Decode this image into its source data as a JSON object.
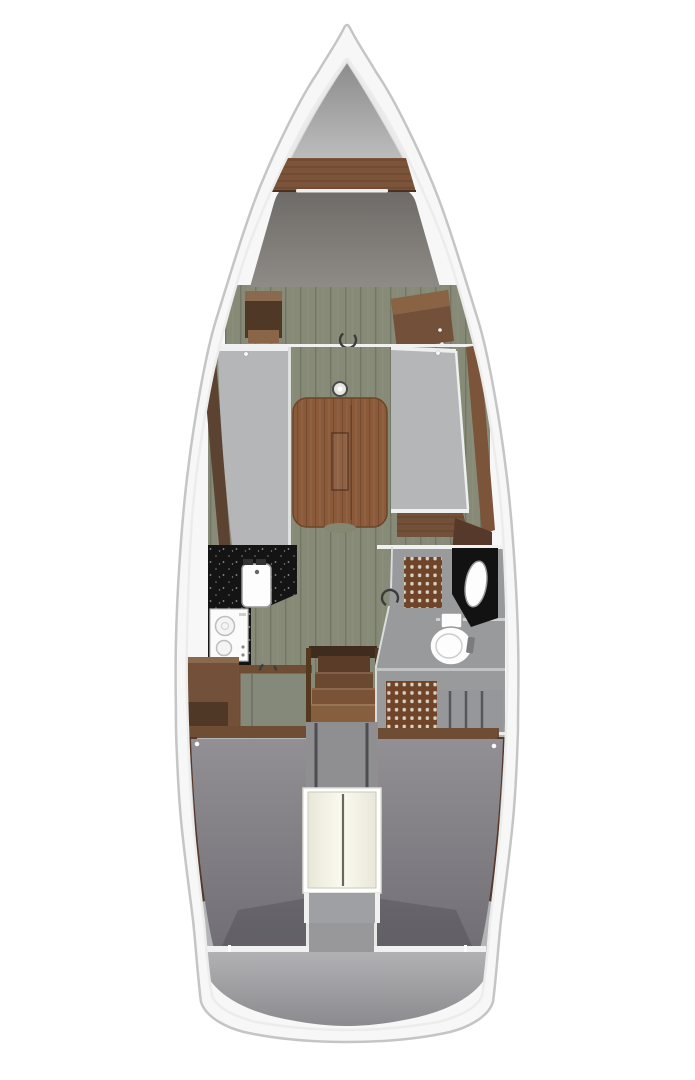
{
  "diagram": {
    "type": "sailboat-interior-floorplan",
    "view": "top-down",
    "areas": [
      {
        "id": "anchor-locker",
        "label": "Anchor locker (bow)"
      },
      {
        "id": "v-berth",
        "label": "Forward V-berth cabin"
      },
      {
        "id": "forward-cabinets",
        "label": "Forward cabin cabinets"
      },
      {
        "id": "salon",
        "label": "Salon with folding table and port/starboard settees"
      },
      {
        "id": "galley",
        "label": "L-shaped galley with sink and two-burner stove"
      },
      {
        "id": "companionway",
        "label": "Companionway stairs"
      },
      {
        "id": "head",
        "label": "Head with toilet, vanity sink and teak shower gratings"
      },
      {
        "id": "aft-cabin-port",
        "label": "Aft cabin berth (port)"
      },
      {
        "id": "aft-cabin-starboard",
        "label": "Aft cabin berth (starboard)"
      },
      {
        "id": "engine-compartment",
        "label": "Engine compartment box"
      },
      {
        "id": "stern",
        "label": "Stern / transom area"
      }
    ]
  },
  "colors": {
    "background": "#ffffff",
    "hull": "#f7f7f7",
    "hull_stroke": "#c5c5c5",
    "inner_band": "#ececec",
    "bow_shade": "#e9e9e9",
    "locker_top": "#8c8c8c",
    "locker_bottom": "#bdbdbd",
    "wood_shelf": "#7c5439",
    "vberth_top": "#6f6b68",
    "vberth_bottom": "#8e8b86",
    "pillow_line": "#eef0f0",
    "floor": "#868a77",
    "bulkhead": "#f1f1f1",
    "trim_port": "#5c4230",
    "trim_starboard": "#7b543a",
    "settee": "#b5b6b8",
    "settee_edge": "#eef0f0",
    "table_wood": "#8a5a3b",
    "table_stroke": "#6d4527",
    "mast_ring": "#4a4a4a",
    "counter": "#141414",
    "appliance": "#fbfbfb",
    "appliance_stroke": "#bdbdbd",
    "cabinet": "#73503a",
    "cabinet_dark": "#503827",
    "cabinet_top": "#8a6a4e",
    "greenish_cabinet_top": "#85897a",
    "step1": "#5a3c29",
    "step2": "#6b4830",
    "step3": "#7a5336",
    "step4": "#86603e",
    "stair_rail": "#54381f",
    "under_stairs": "#8f8f92",
    "under_stairs_line": "#4c4c52",
    "head_floor": "#999a9c",
    "grating": "#6f4428",
    "grating_dot": "#d8d1c4",
    "vanity": "#121212",
    "porcelain": "#fdfdfd",
    "porcelain_stroke": "#9a9a9a",
    "lockers_gray": "#96979a",
    "aft_base": "#b3b4b6",
    "center_channel": "#98989b",
    "berth_top": "#929094",
    "berth_bottom": "#716e75",
    "berth_header": "#6f4c34",
    "side_wood": "#56392a",
    "engine_frame_stroke": "#ddddd5",
    "engine_edge": "#e9e7d8",
    "engine_mid": "#fbfaf0",
    "engine_divider": "#68685e",
    "recess": "#9fa0a3",
    "stern_top": "#b1b1b4",
    "stern_bottom": "#8b8b8f",
    "door_marker": "#3c3c3c",
    "button_dot": "#fafafa"
  }
}
